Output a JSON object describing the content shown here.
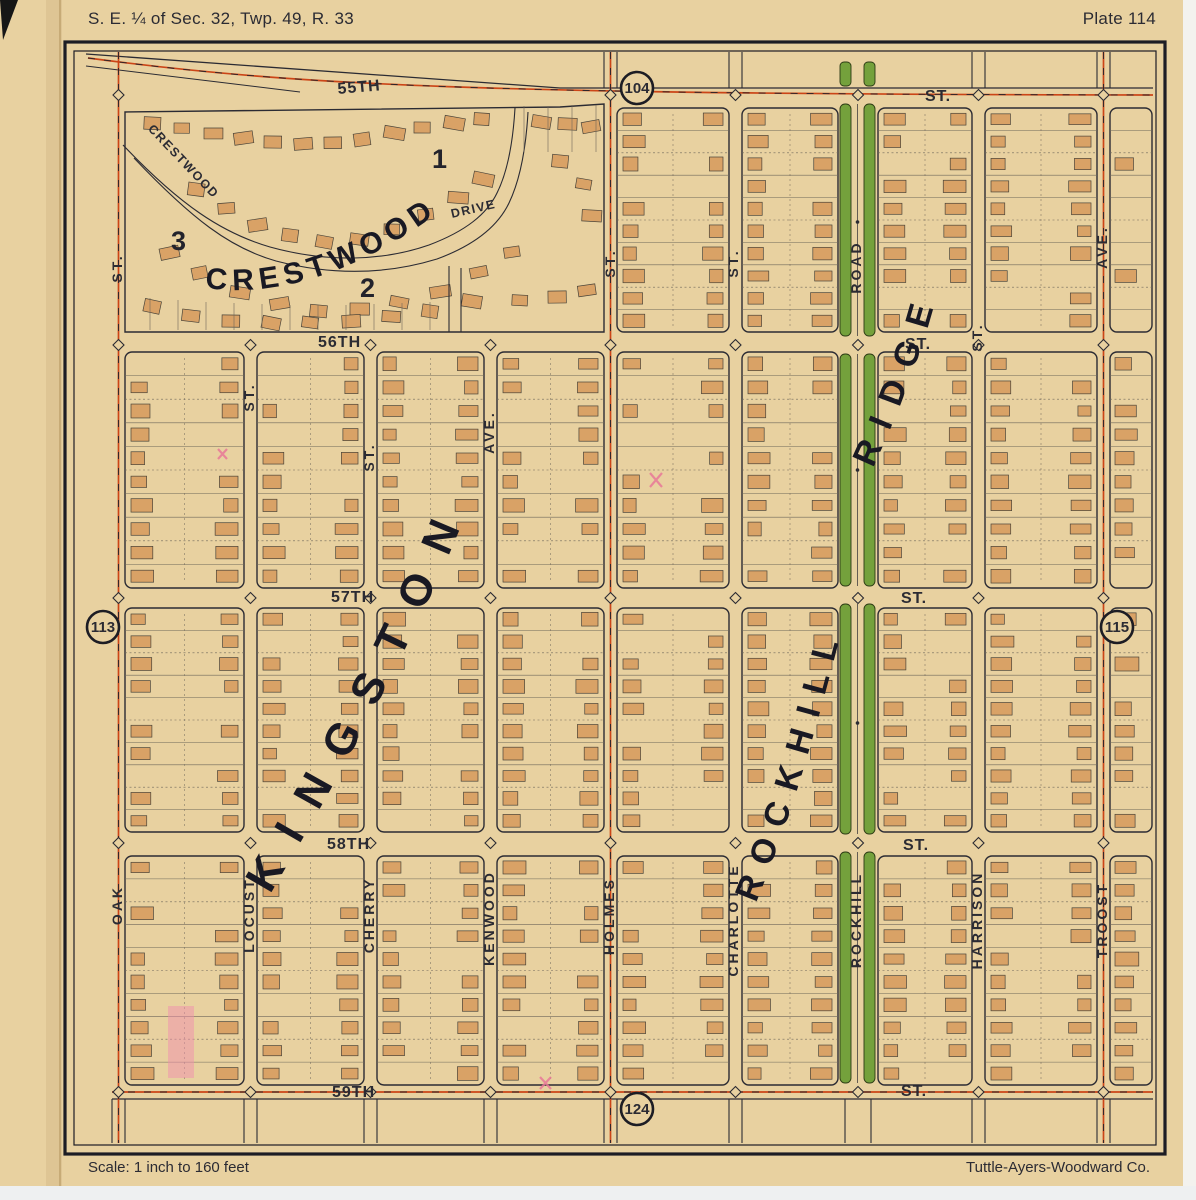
{
  "page": {
    "title": "S. E. ¼ of Sec. 32, Twp. 49, R. 33",
    "plate": "Plate 114",
    "scale_note": "Scale:  1 inch to 160 feet",
    "publisher": "Tuttle-Ayers-Woodward Co."
  },
  "adjacent_plates": {
    "north": "104",
    "south": "124",
    "west": "113",
    "east": "115"
  },
  "streets": {
    "horizontal": [
      {
        "name": "55TH",
        "suffix": "ST."
      },
      {
        "name": "56TH",
        "suffix": "ST."
      },
      {
        "name": "57TH",
        "suffix": "ST."
      },
      {
        "name": "58TH",
        "suffix": "ST."
      },
      {
        "name": "59TH",
        "suffix": "ST."
      }
    ],
    "vertical": [
      {
        "name": "OAK",
        "suffix": "ST."
      },
      {
        "name": "LOCUST",
        "suffix": "ST."
      },
      {
        "name": "CHERRY",
        "suffix": "ST."
      },
      {
        "name": "KENWOOD",
        "suffix": "AVE."
      },
      {
        "name": "HOLMES",
        "suffix": "ST."
      },
      {
        "name": "CHARLOTTE",
        "suffix": "ST."
      },
      {
        "name": "ROCKHILL",
        "suffix": "ROAD"
      },
      {
        "name": "HARRISON",
        "suffix": "ST."
      },
      {
        "name": "TROOST",
        "suffix": "AVE."
      }
    ],
    "curved": [
      {
        "name": "CRESTWOOD",
        "suffix": "DRIVE"
      }
    ]
  },
  "subdivision_labels": {
    "crestwood": "CRESTWOOD",
    "kingston": "KINGSTON",
    "rockhill": "ROCKHILL",
    "ridge": "RIDGE"
  },
  "block_numbers": [
    "1",
    "2",
    "3"
  ],
  "colors": {
    "paper": "#e8d1a0",
    "ink": "#2b2b33",
    "house_fill": "#d9a266",
    "boulevard_green": "#74a13c",
    "car_line_red": "#cb4517",
    "highlight_pink": "#ef8fae"
  }
}
